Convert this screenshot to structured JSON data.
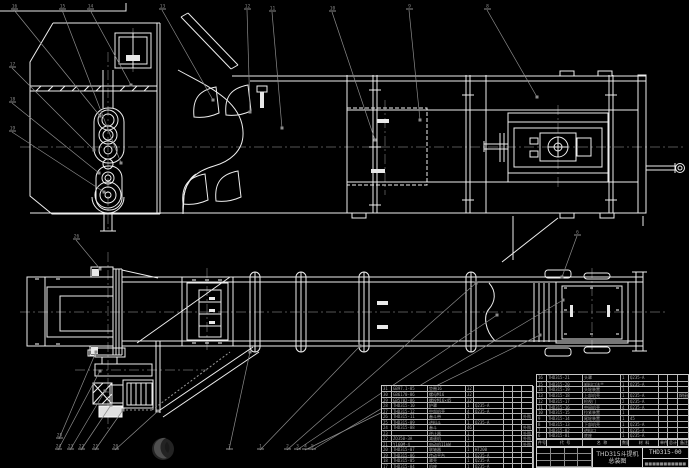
{
  "drawing": {
    "product": "THD315斗提机",
    "sheet_title": "总装图",
    "drawing_number": "THD315-00",
    "company_line": "■■■■■■■■■■■"
  },
  "colors": {
    "background": "#000000",
    "line": "#f0f0f0",
    "leader": "#8c8c8c",
    "centerline": "#707070",
    "table_text": "#a8a8a8",
    "logo_dark": "#2e2e2e",
    "logo_light": "#535353"
  },
  "bom": {
    "header": [
      "件号",
      "代 号",
      "名 称",
      "数量",
      "材 料",
      "单件",
      "总计",
      "备注"
    ],
    "left_rows": [
      [
        "31",
        "GB97.1-85",
        "垫圈16",
        "32",
        "",
        "",
        "",
        ""
      ],
      [
        "30",
        "GB6170-86",
        "螺母M16",
        "32",
        "",
        "",
        "",
        ""
      ],
      [
        "29",
        "GB5782-86",
        "螺栓M16×45",
        "32",
        "",
        "",
        "",
        ""
      ],
      [
        "28",
        "THD315-10",
        "护罩",
        "1",
        "Q235-A",
        "",
        "",
        ""
      ],
      [
        "27",
        "THD315-12",
        "中部机壳",
        "4",
        "Q235-A",
        "",
        "",
        ""
      ],
      [
        "26",
        "THD315-11",
        "畚斗带",
        "1",
        "",
        "",
        "",
        "外购"
      ],
      [
        "25",
        "THD315-09",
        "进料斗",
        "1",
        "Q235-A",
        "",
        "",
        ""
      ],
      [
        "24",
        "THD315-08",
        "畚斗",
        "46",
        "",
        "",
        "",
        "外购"
      ],
      [
        "23",
        "",
        "逆止器",
        "1",
        "",
        "",
        "",
        "外购"
      ],
      [
        "22",
        "ZQ350-3A",
        "减速机",
        "1",
        "",
        "",
        "",
        "外购"
      ],
      [
        "21",
        "Y160M-4",
        "电动机11kW",
        "1",
        "",
        "",
        "",
        "外购"
      ],
      [
        "20",
        "THD315-07",
        "联轴器",
        "1",
        "HT200",
        "",
        "",
        ""
      ],
      [
        "19",
        "THD315-06",
        "传动平台",
        "1",
        "Q235-A",
        "",
        "",
        ""
      ],
      [
        "18",
        "THD315-05",
        "罩壳",
        "1",
        "Q235-A",
        "",
        "",
        ""
      ],
      [
        "17",
        "THD315-04",
        "机座",
        "1",
        "Q235-A",
        "",
        "",
        ""
      ]
    ],
    "right_rows": [
      [
        "16",
        "THD315-21",
        "头罩",
        "1",
        "Q235-A",
        "",
        "",
        ""
      ],
      [
        "15",
        "THD315-20",
        "卸料口法兰",
        "1",
        "Q235-A",
        "",
        "",
        ""
      ],
      [
        "14",
        "THD315-19",
        "头轮装置",
        "1",
        "",
        "",
        "",
        ""
      ],
      [
        "13",
        "THD315-18",
        "上部机壳",
        "1",
        "Q235-A",
        "",
        "",
        "焊接件"
      ],
      [
        "12",
        "THD315-17",
        "检视门",
        "2",
        "Q235-A",
        "",
        "",
        ""
      ],
      [
        "11",
        "THD315-16",
        "中间机壳",
        "4",
        "Q235-A",
        "",
        "",
        ""
      ],
      [
        "10",
        "THD315-15",
        "拉紧装置",
        "1",
        "",
        "",
        "",
        ""
      ],
      [
        "9",
        "THD315-14",
        "尾轮装置",
        "1",
        "45",
        "",
        "",
        ""
      ],
      [
        "8",
        "THD315-13",
        "下部机壳",
        "1",
        "Q235-A",
        "",
        "",
        ""
      ],
      [
        "7",
        "THD315-02",
        "进料口",
        "1",
        "Q235-A",
        "",
        "",
        ""
      ],
      [
        "6",
        "THD315-01",
        "底座",
        "1",
        "Q235-A",
        "",
        "",
        ""
      ]
    ]
  },
  "callouts": [
    {
      "label": "16",
      "x": 12,
      "y": 8,
      "ex": 100,
      "ey": 116
    },
    {
      "label": "15",
      "x": 60,
      "y": 8,
      "ex": 121,
      "ey": 163
    },
    {
      "label": "14",
      "x": 88,
      "y": 8,
      "ex": 131,
      "ey": 85
    },
    {
      "label": "13",
      "x": 160,
      "y": 8,
      "ex": 213,
      "ey": 100
    },
    {
      "label": "12",
      "x": 245,
      "y": 8,
      "ex": 250,
      "ey": 112
    },
    {
      "label": "11",
      "x": 270,
      "y": 10,
      "ex": 282,
      "ey": 128
    },
    {
      "label": "10",
      "x": 330,
      "y": 10,
      "ex": 375,
      "ey": 140
    },
    {
      "label": "9",
      "x": 407,
      "y": 8,
      "ex": 420,
      "ey": 120
    },
    {
      "label": "8",
      "x": 485,
      "y": 8,
      "ex": 537,
      "ey": 97
    },
    {
      "label": "17",
      "x": 10,
      "y": 66,
      "ex": 94,
      "ey": 150
    },
    {
      "label": "18",
      "x": 10,
      "y": 101,
      "ex": 99,
      "ey": 173
    },
    {
      "label": "19",
      "x": 10,
      "y": 130,
      "ex": 104,
      "ey": 192
    },
    {
      "label": "26",
      "x": 74,
      "y": 238,
      "ex": 100,
      "ey": 269
    },
    {
      "label": "25",
      "x": 57,
      "y": 437,
      "ex": 96,
      "ey": 352
    },
    {
      "label": "24",
      "x": 56,
      "y": 448,
      "ex": 100,
      "ey": 371
    },
    {
      "label": "23",
      "x": 68,
      "y": 448,
      "ex": 105,
      "ey": 391
    },
    {
      "label": "22",
      "x": 79,
      "y": 448,
      "ex": 111,
      "ey": 405
    },
    {
      "label": "21",
      "x": 93,
      "y": 448,
      "ex": 123,
      "ey": 410
    },
    {
      "label": "20",
      "x": 113,
      "y": 448,
      "ex": 158,
      "ey": 411
    },
    {
      "label": "7",
      "x": 227,
      "y": 448,
      "ex": 250,
      "ey": 352
    },
    {
      "label": "1",
      "x": 258,
      "y": 448,
      "ex": 360,
      "ey": 346
    },
    {
      "label": "2",
      "x": 285,
      "y": 448,
      "ex": 476,
      "ey": 283
    },
    {
      "label": "3",
      "x": 295,
      "y": 448,
      "ex": 497,
      "ey": 315
    },
    {
      "label": "4",
      "x": 303,
      "y": 448,
      "ex": 540,
      "ey": 335
    },
    {
      "label": "5",
      "x": 310,
      "y": 448,
      "ex": 563,
      "ey": 300
    },
    {
      "label": "6",
      "x": 575,
      "y": 234,
      "ex": 562,
      "ey": 277
    }
  ]
}
